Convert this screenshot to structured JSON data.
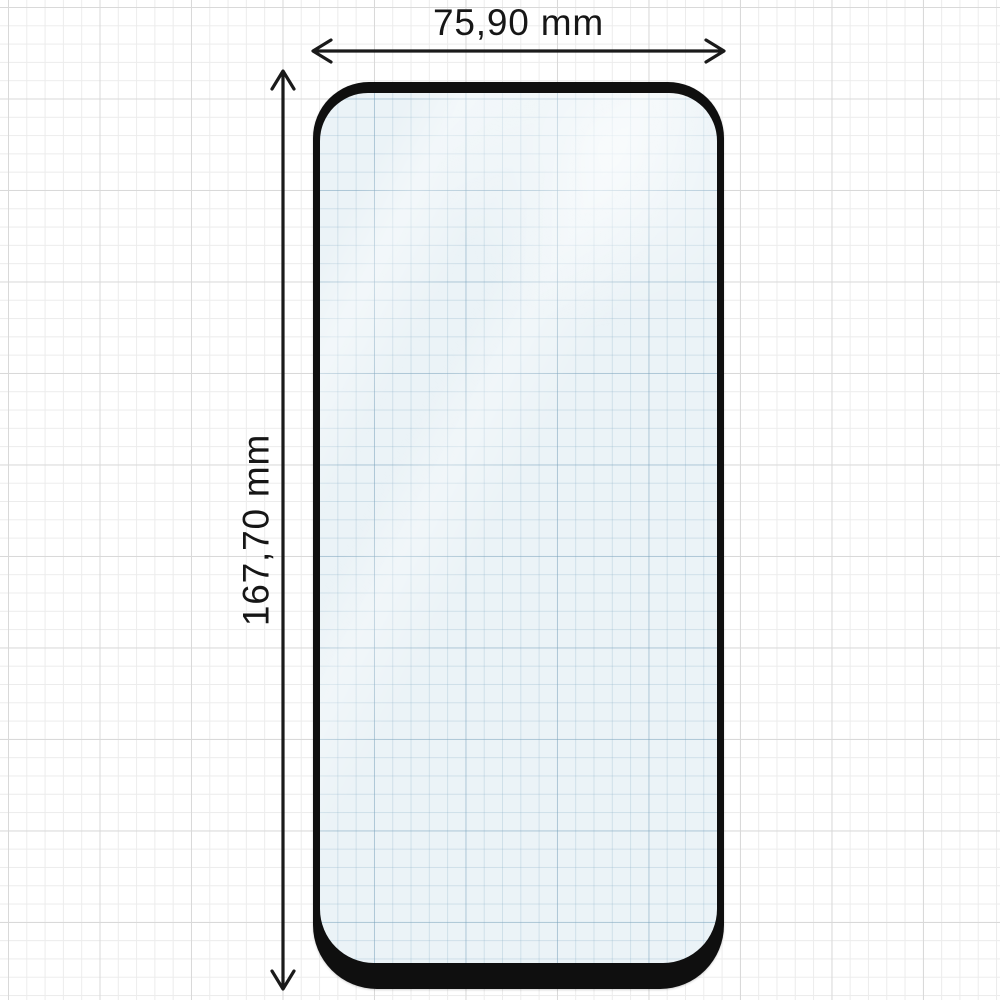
{
  "diagram": {
    "title": "screen protector dimension drawing",
    "width_label": "75,90 mm",
    "height_label": "167,70 mm"
  },
  "colors": {
    "background": "#ffffff",
    "grid_minor": "#ececec",
    "grid_major": "#d9d9d9",
    "frame_black": "#0f0f0f",
    "glass_tint": "#ebf3f7",
    "glass_grid_minor": "rgba(142,178,200,0.30)",
    "glass_grid_major": "rgba(120,160,185,0.38)",
    "dimension_line": "#1a1a1a",
    "label_text": "#161616"
  },
  "icons": {
    "width_arrow": "horizontal-double-arrow",
    "height_arrow": "vertical-double-arrow"
  }
}
